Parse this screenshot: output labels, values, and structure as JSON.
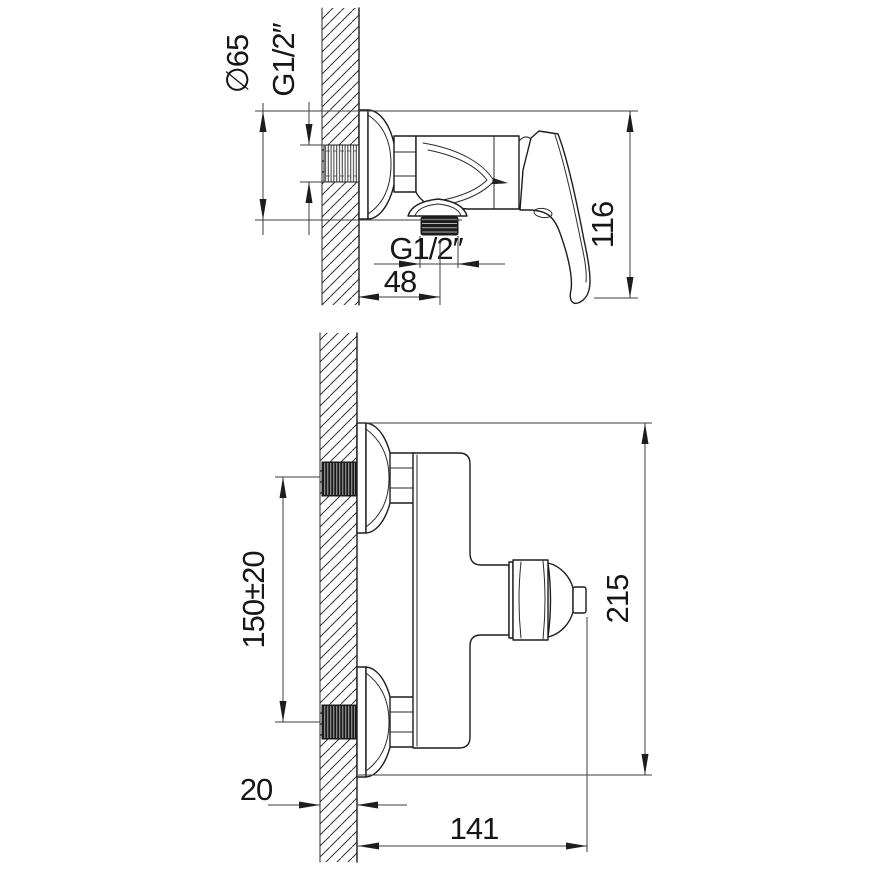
{
  "drawing": {
    "type": "technical-installation-drawing",
    "colors": {
      "line": "#1d1d1d",
      "dimension": "#3d3d3d",
      "background": "#ffffff"
    },
    "side_view": {
      "dims": {
        "escutcheon_diameter": "∅65",
        "wall_thread": "G1/2″",
        "body_height": "116",
        "outlet_offset": "48",
        "outlet_thread": "G1/2″"
      }
    },
    "front_view": {
      "dims": {
        "inlet_spacing": "150±20",
        "overall_height": "215",
        "wall_thickness": "20",
        "reach": "141"
      }
    }
  }
}
